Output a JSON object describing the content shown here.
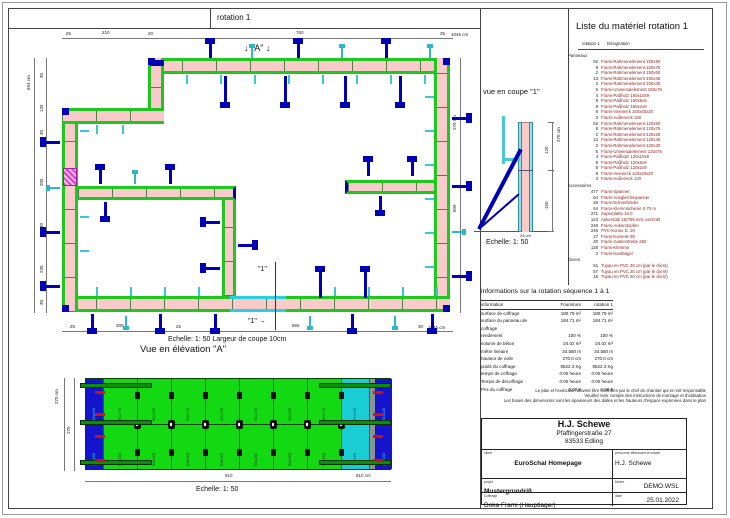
{
  "plan": {
    "title": "rotation 1",
    "marker_a": "↓ \"A\" ↓",
    "cut_label_top": "\"1\"",
    "cut_label_bottom": "\"1\" →",
    "caption": "Echelle: 1: 50   Largeur de coupe 10cm",
    "dims": {
      "top": [
        "25",
        "210",
        "20",
        "760",
        "35",
        "1045 cm"
      ],
      "left": [
        "694 cm",
        "30",
        "139",
        "30",
        "205",
        "30",
        "230",
        "30"
      ],
      "bottom": [
        "25",
        "300",
        "25",
        "865",
        "30",
        "1045 cm"
      ],
      "right": [
        "270 cm",
        "609"
      ]
    }
  },
  "section": {
    "title": "vue en coupe \"1\"",
    "scale": "Echelle: 1: 50",
    "dims": {
      "total": "270 cm",
      "top": "120",
      "bottom": "150",
      "width": "25 cm"
    }
  },
  "elevation": {
    "title": "Vue en élévation \"A\"",
    "scale": "Echelle: 1: 50",
    "dims": {
      "height_total": "270 cm",
      "height": "270",
      "width": "810",
      "width_total": "810 cm"
    },
    "panels": [
      {
        "type": "end",
        "top": "45x120",
        "bottom": "45x150"
      },
      {
        "type": "std",
        "top": "90x120",
        "bottom": "90x150"
      },
      {
        "type": "std",
        "top": "90x120",
        "bottom": "90x150"
      },
      {
        "type": "std",
        "top": "90x120",
        "bottom": "90x150"
      },
      {
        "type": "std",
        "top": "90x120",
        "bottom": "90x150"
      },
      {
        "type": "std",
        "top": "90x120",
        "bottom": "90x150"
      },
      {
        "type": "std",
        "top": "90x120",
        "bottom": "90x150"
      },
      {
        "type": "std",
        "top": "90x120",
        "bottom": "90x150"
      },
      {
        "type": "fill",
        "top": "75x120",
        "bottom": "75x150"
      },
      {
        "type": "strip",
        "top": "",
        "bottom": ""
      },
      {
        "type": "end",
        "top": "45x120",
        "bottom": "45x150"
      }
    ]
  },
  "materials": {
    "title": "Liste du matériel  rotation 1",
    "col1": "rotation 1",
    "col2": "Désignation",
    "sections": [
      {
        "name": "Panneaux",
        "items": [
          {
            "qty": "52",
            "name": "Frami-Rahmenelement 150x90"
          },
          {
            "qty": "8",
            "name": "Frami-Rahmenelement 150x75"
          },
          {
            "qty": "2",
            "name": "Frami-Rahmenelement 150x60"
          },
          {
            "qty": "13",
            "name": "Frami-Rahmenelement 150x45"
          },
          {
            "qty": "2",
            "name": "Frami-Rahmenelement 150x30"
          },
          {
            "qty": "5",
            "name": "Frami-Universalelement 150x75"
          },
          {
            "qty": "4",
            "name": "Frami-Paßholz 150x10x9"
          },
          {
            "qty": "9",
            "name": "Frami-Paßholz 150x5x9"
          },
          {
            "qty": "8",
            "name": "Frami-Paßholz 150x2x9"
          },
          {
            "qty": "8",
            "name": "Frami-Inneneck 150x20x20"
          },
          {
            "qty": "3",
            "name": "Frami-Außeneck 150"
          },
          {
            "qty": "52",
            "name": "Frami-Rahmenelement 120x90"
          },
          {
            "qty": "8",
            "name": "Frami-Rahmenelement 120x75"
          },
          {
            "qty": "2",
            "name": "Frami-Rahmenelement 120x60"
          },
          {
            "qty": "13",
            "name": "Frami-Rahmenelement 120x45"
          },
          {
            "qty": "2",
            "name": "Frami-Rahmenelement 120x30"
          },
          {
            "qty": "5",
            "name": "Frami-Universalelement 120x75"
          },
          {
            "qty": "4",
            "name": "Frami-Paßholz 120x10x9"
          },
          {
            "qty": "9",
            "name": "Frami-Paßholz 120x5x9"
          },
          {
            "qty": "8",
            "name": "Frami-Paßholz 120x2x9"
          },
          {
            "qty": "8",
            "name": "Frami-Inneneck 120x20x20"
          },
          {
            "qty": "3",
            "name": "Frami-Außeneck 120"
          }
        ]
      },
      {
        "name": "Accessoires",
        "items": [
          {
            "qty": "477",
            "name": "Frami-Spanner"
          },
          {
            "qty": "64",
            "name": "Frami-Ausgleichsspanner"
          },
          {
            "qty": "26",
            "name": "Frami-Eckverbinder"
          },
          {
            "qty": "64",
            "name": "Frami-Klemmschiene 0.70 m"
          },
          {
            "qty": "271",
            "name": "Superplatte 15,0"
          },
          {
            "qty": "123",
            "name": "Ankerstab 15/750 mm, verzinkt"
          },
          {
            "qty": "246",
            "name": "Frami-Ankerstopfen"
          },
          {
            "qty": "246",
            "name": "PVC-Konus D. 20"
          },
          {
            "qty": "27",
            "name": "Frami-Konsole 90"
          },
          {
            "qty": "20",
            "name": "Frami-Justierstrebe 260"
          },
          {
            "qty": "128",
            "name": "Frami-Klemme"
          },
          {
            "qty": "2",
            "name": "Frami-Kantbügel"
          }
        ]
      },
      {
        "name": "Divers",
        "items": [
          {
            "qty": "51",
            "name": "Tuyau en PVC 30 cm (par le client)"
          },
          {
            "qty": "57",
            "name": "Tuyau en PVC 25 cm (par le client)"
          },
          {
            "qty": "15",
            "name": "Tuyau en PVC 20 cm (par le client)"
          }
        ]
      }
    ]
  },
  "info": {
    "title": "informations sur la rotation  séquence 1 à 1",
    "columns": [
      "information",
      "Fourniture",
      "rotation 1"
    ],
    "rows": [
      [
        "surface de coffrage",
        "180.79 m²",
        "180.79 m²"
      ],
      [
        "surface du panneau de coffrage",
        "184.71 m²",
        "184.71 m²"
      ],
      [
        "rendement",
        "100 %",
        "100 %"
      ],
      [
        "volume de béton",
        "24.02 m³",
        "24.02 m³"
      ],
      [
        "mètre linéaire",
        "34.580 m",
        "34.580 m"
      ],
      [
        "hauteur de voile",
        "270.0 cm",
        "270.0 cm"
      ],
      [
        "poids du coffrage",
        "8622.3 Kg",
        "8622.3 Kg"
      ],
      [
        "temps de coffrage",
        "0.00 heure",
        "0.00 heure"
      ],
      [
        "Temps de décoffrage",
        "0.00 heure",
        "0.00 heure"
      ],
      [
        "Prix du coffrage",
        "0.00 €",
        "0.00 €"
      ]
    ]
  },
  "notes": [
    "Le plan et l'exécution doivent être contrôlés par le chef de chantier qui en est responsable",
    "Veuillez tenir compte des instructions de montage et d'utilisation",
    "Les bases des dimensions sont les épaisseurs des dalles et les hauteurs d'espace exprimées dans le plan"
  ],
  "titleblock": {
    "company": "H.J. Schewe",
    "address1": "Pfaffingerstraße 27",
    "address2": "83533 Edling",
    "client_label": "client",
    "client": "EuroSchal Homepage",
    "person_label": "personne effectuant le travail",
    "person": "H.J. Schewe",
    "project_label": "projet",
    "project": "Mustergrundriß",
    "file_label": "fichier",
    "file": "DEMO.WSL",
    "formwork_label": "Coffrage",
    "formwork": "Doka Frami (Hauptlager)",
    "date_label": "date",
    "date": "25.01.2022"
  },
  "colors": {
    "wall_pink": "#f8caca",
    "formwork_green": "#1ec81e",
    "panel_green": "#12d912",
    "panel_cyan": "#19cdd4",
    "panel_blue": "#1414cc",
    "strip_gray": "#8a9494",
    "brace_blue": "#0000b4",
    "brace_cyan": "#2fb6c9",
    "clamp_red": "#d01010",
    "accent_magenta": "#d840d8",
    "list_text_red": "#8c1a1a"
  }
}
